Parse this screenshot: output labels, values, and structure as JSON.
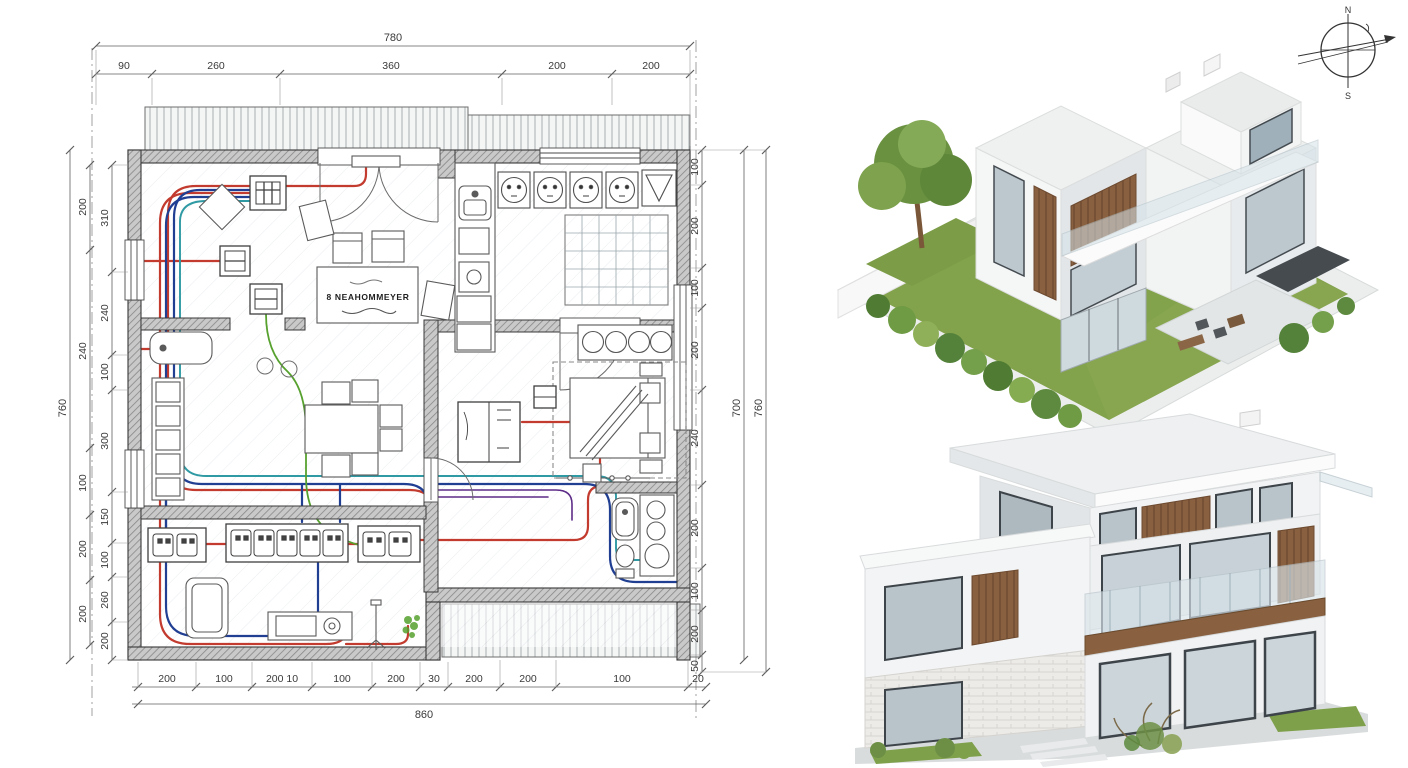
{
  "sheet": {
    "background": "#ffffff"
  },
  "compass": {
    "north": "N",
    "south": "S"
  },
  "plan": {
    "table_label": "8 NEAHOMMEYER",
    "dims": {
      "top_total": "780",
      "top": [
        "90",
        "260",
        "360",
        "200",
        "200"
      ],
      "bottom": [
        "200",
        "100",
        "200 10",
        "100",
        "200",
        "30",
        "200",
        "200",
        "100",
        "20"
      ],
      "bottom_total": "860",
      "left_outer": "760",
      "left_mid": [
        "200",
        "240",
        "100",
        "200",
        "200"
      ],
      "left_inner": [
        "310",
        "240",
        "100",
        "300",
        "150",
        "100",
        "260",
        "200"
      ],
      "right_inner": [
        "100",
        "200",
        "100",
        "200",
        "240",
        "200",
        "100",
        "200",
        "50"
      ],
      "right_mid": "700",
      "right_outer": "760"
    },
    "colors": {
      "wire_red": "#c23b2e",
      "wire_blue": "#203e92",
      "wire_teal": "#2f9aa3",
      "wire_green": "#57a12f",
      "wire_purple": "#5d2c87",
      "wall_line": "#3c3c3c",
      "dim_line": "#555555"
    }
  },
  "renders": {
    "grass": "#83a24c",
    "wood": "#8a6140",
    "glass": "#bcc7ce",
    "concrete": "#e9ebec",
    "hedge_dark": "#4f7b33",
    "hedge_light": "#8fb058"
  }
}
